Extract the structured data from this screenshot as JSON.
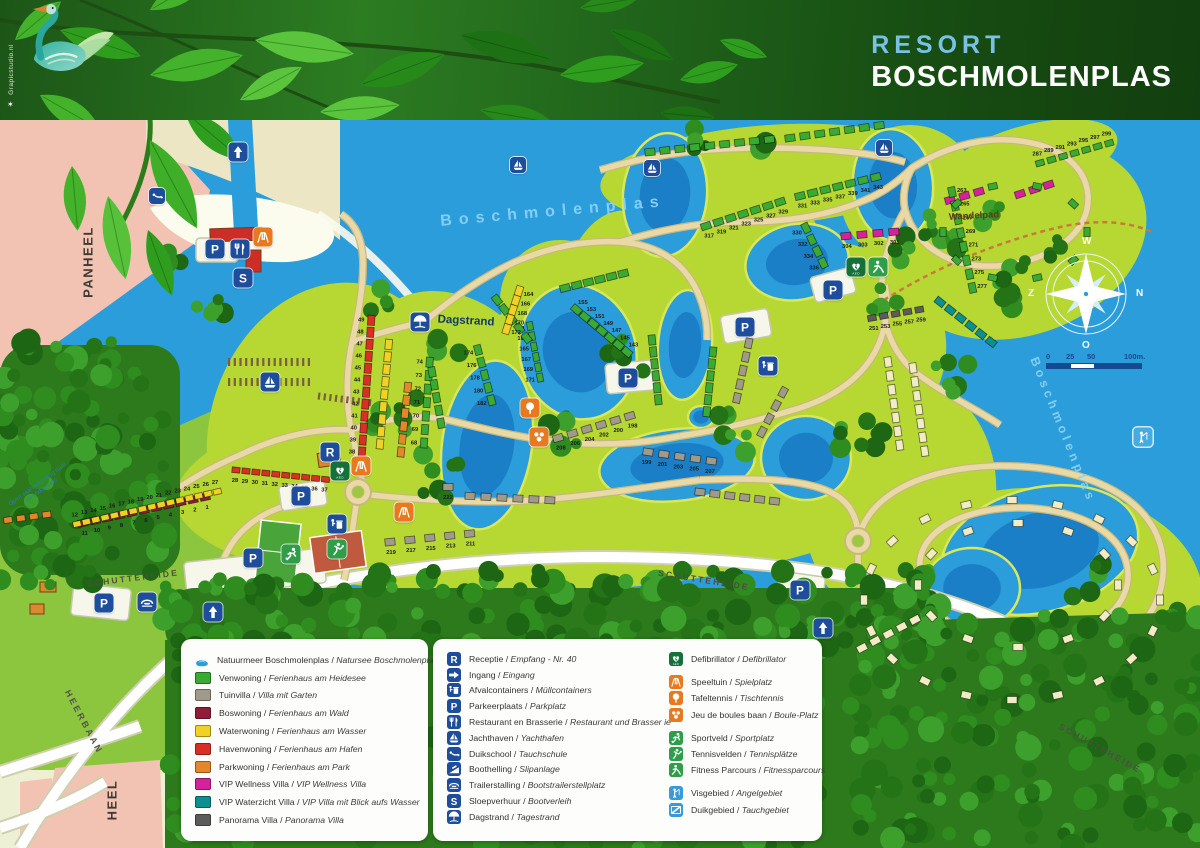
{
  "banner": {
    "resort_word": "RESORT",
    "name_word": "BOSCHMOLENPLAS",
    "watermark": "Grapicstudio.nl"
  },
  "palette": {
    "water": "#2b9ddb",
    "water_deep": "#1a7fc6",
    "land": "#edf0d2",
    "resort": "#b7d733",
    "grass": "#8cc63f",
    "pink_area": "#f2c3b2",
    "beach": "#fbfbee",
    "sand_strip": "#ece6c4",
    "road": "#e8d9a6",
    "road_edge": "#c9b87e",
    "forest_base": "#2c7a1b",
    "icon_blue": "#1d4d9b",
    "icon_green_dark": "#15713a",
    "icon_green": "#2e9e48",
    "icon_orange": "#e8791f",
    "icon_lightblue": "#3b9ad6",
    "venwoning": "#3aaa35",
    "tuinvilla": "#a09a8a",
    "boswoning": "#8f1d3a",
    "waterwoning": "#f2d126",
    "havenwoning": "#d93026",
    "parkwoning": "#e2882b",
    "vip_wellness": "#d6219c",
    "vip_waterzicht": "#0b8f8f",
    "panorama": "#5c5c5c",
    "cream": "#f2ecc4"
  },
  "compass": {
    "top": "W",
    "right": "N",
    "bottom": "O",
    "left": "Z"
  },
  "scalebar": {
    "labels": [
      "0",
      "25",
      "50",
      "100m."
    ]
  },
  "map": {
    "labels": [
      {
        "t": "PANHEEL",
        "x": 88,
        "y": 262,
        "r": -90,
        "cls": "place"
      },
      {
        "t": "HEEL",
        "x": 112,
        "y": 800,
        "r": -90,
        "cls": "place"
      },
      {
        "t": "HEERBAAN",
        "x": 84,
        "y": 722,
        "r": 62,
        "cls": "road-b"
      },
      {
        "t": "SCHUTTEHEIDE",
        "x": 133,
        "y": 578,
        "r": -7,
        "cls": "road"
      },
      {
        "t": "SCHUTTEHEIDE",
        "x": 704,
        "y": 580,
        "r": 9,
        "cls": "road"
      },
      {
        "t": "SCHUTTEHEIDE",
        "x": 1100,
        "y": 748,
        "r": 29,
        "cls": "road"
      },
      {
        "t": "Wandelpad",
        "x": 974,
        "y": 216,
        "r": -3,
        "cls": "pathl"
      },
      {
        "t": "Dagstrand",
        "x": 466,
        "y": 321,
        "r": 3,
        "cls": "dagstrand"
      },
      {
        "t": "Boschmolenplas",
        "x": 553,
        "y": 212,
        "r": -5,
        "cls": "water"
      },
      {
        "t": "Boschmolenplas",
        "x": 1063,
        "y": 430,
        "r": 68,
        "cls": "water sm"
      },
      {
        "t": "Open vaarverbinding naar de Middelplas",
        "x": 40,
        "y": 488,
        "r": -36,
        "cls": "tinyw"
      }
    ],
    "markers": [
      {
        "t": "ingang",
        "x": 238,
        "y": 152
      },
      {
        "t": "duikschool",
        "x": 157,
        "y": 196,
        "s": 16
      },
      {
        "t": "parkeer",
        "x": 215,
        "y": 249
      },
      {
        "t": "restaurant",
        "x": 240,
        "y": 249
      },
      {
        "t": "sloep",
        "x": 243,
        "y": 278
      },
      {
        "t": "speeltuin",
        "x": 263,
        "y": 237
      },
      {
        "t": "jachthaven",
        "x": 270,
        "y": 382
      },
      {
        "t": "dagstrand",
        "x": 420,
        "y": 322
      },
      {
        "t": "receptie",
        "x": 330,
        "y": 452
      },
      {
        "t": "defib",
        "x": 340,
        "y": 471
      },
      {
        "t": "speeltuin",
        "x": 361,
        "y": 466
      },
      {
        "t": "speeltuin",
        "x": 404,
        "y": 512
      },
      {
        "t": "parkeer",
        "x": 301,
        "y": 496
      },
      {
        "t": "afval",
        "x": 337,
        "y": 524
      },
      {
        "t": "tennis",
        "x": 337,
        "y": 549
      },
      {
        "t": "sportveld",
        "x": 291,
        "y": 554
      },
      {
        "t": "parkeer",
        "x": 253,
        "y": 558
      },
      {
        "t": "trailer",
        "x": 147,
        "y": 602
      },
      {
        "t": "parkeer",
        "x": 104,
        "y": 603
      },
      {
        "t": "ingang",
        "x": 213,
        "y": 612
      },
      {
        "t": "tafeltennis",
        "x": 530,
        "y": 408
      },
      {
        "t": "boules",
        "x": 539,
        "y": 437
      },
      {
        "t": "parkeer",
        "x": 628,
        "y": 378
      },
      {
        "t": "parkeer",
        "x": 745,
        "y": 327
      },
      {
        "t": "afval",
        "x": 768,
        "y": 366
      },
      {
        "t": "parkeer",
        "x": 833,
        "y": 290
      },
      {
        "t": "defib",
        "x": 856,
        "y": 267
      },
      {
        "t": "fitness",
        "x": 878,
        "y": 267
      },
      {
        "t": "jachthaven",
        "x": 518,
        "y": 165,
        "s": 16
      },
      {
        "t": "jachthaven",
        "x": 652,
        "y": 168,
        "s": 16
      },
      {
        "t": "jachthaven",
        "x": 884,
        "y": 148,
        "s": 16
      },
      {
        "t": "vis",
        "x": 1143,
        "y": 437,
        "light": true
      },
      {
        "t": "parkeer",
        "x": 800,
        "y": 590
      },
      {
        "t": "ingang",
        "x": 823,
        "y": 628
      }
    ],
    "house_clusters": [
      {
        "x": 205,
        "y": 497,
        "a": 168,
        "n": 11,
        "c": "boswoning",
        "g": 12.5,
        "num": 1,
        "side": -1
      },
      {
        "x": 77,
        "y": 524,
        "a": -13,
        "n": 16,
        "c": "waterwoning",
        "g": 9.6,
        "s": 0.8,
        "num": 12,
        "side": -1
      },
      {
        "x": 236,
        "y": 470,
        "a": 6,
        "n": 10,
        "c": "havenwoning",
        "g": 10,
        "s": 0.8,
        "num": 28,
        "side": 1
      },
      {
        "x": 362,
        "y": 452,
        "a": -86,
        "n": 12,
        "c": "havenwoning",
        "g": 12,
        "num": 38,
        "side": -1
      },
      {
        "x": 380,
        "y": 444,
        "a": -85,
        "n": 9,
        "c": "waterwoning",
        "g": 12.5
      },
      {
        "x": 424,
        "y": 443,
        "a": -86,
        "n": 7,
        "c": "venwoning",
        "g": 13.5,
        "num": 68,
        "side": -1
      },
      {
        "x": 401,
        "y": 452,
        "a": -84,
        "n": 6,
        "c": "parkwoning",
        "g": 13
      },
      {
        "x": 8,
        "y": 520,
        "a": -8,
        "n": 4,
        "c": "parkwoning",
        "s": 0.85
      },
      {
        "x": 530,
        "y": 326,
        "a": 79,
        "n": 6,
        "c": "venwoning",
        "g": 10.5,
        "s": 0.85,
        "num": 161,
        "step": 2,
        "side": 1
      },
      {
        "x": 497,
        "y": 300,
        "a": 52,
        "n": 5,
        "c": "venwoning",
        "g": 12
      },
      {
        "x": 627,
        "y": 352,
        "a": -140,
        "n": 7,
        "c": "venwoning",
        "g": 11,
        "num": 143,
        "step": 2,
        "side": 1
      },
      {
        "x": 565,
        "y": 288,
        "a": -14,
        "n": 6,
        "c": "venwoning",
        "g": 12
      },
      {
        "x": 519,
        "y": 291,
        "a": 108,
        "n": 5,
        "c": "waterwoning",
        "g": 10,
        "num": 164,
        "step": 2,
        "side": -1
      },
      {
        "x": 652,
        "y": 340,
        "a": 84,
        "n": 6,
        "c": "venwoning",
        "g": 12
      },
      {
        "x": 713,
        "y": 352,
        "a": 96,
        "n": 6,
        "c": "venwoning",
        "g": 12
      },
      {
        "x": 478,
        "y": 350,
        "a": 75,
        "n": 5,
        "c": "venwoning",
        "g": 13,
        "num": 174,
        "step": 2,
        "side": 1
      },
      {
        "x": 432,
        "y": 372,
        "a": 80,
        "n": 5,
        "c": "venwoning",
        "g": 13
      },
      {
        "x": 390,
        "y": 542,
        "a": -6,
        "n": 5,
        "c": "tuinvilla",
        "g": 20,
        "num": 219,
        "step": -2,
        "side": 1
      },
      {
        "x": 448,
        "y": 487,
        "a": 0,
        "n": 1,
        "c": "tuinvilla",
        "num": 222,
        "side": 1
      },
      {
        "x": 470,
        "y": 496,
        "a": 3,
        "n": 6,
        "c": "tuinvilla",
        "g": 16
      },
      {
        "x": 558,
        "y": 438,
        "a": -17,
        "n": 6,
        "c": "tuinvilla",
        "g": 15,
        "num": 208,
        "step": -2,
        "side": 1
      },
      {
        "x": 648,
        "y": 452,
        "a": 8,
        "n": 5,
        "c": "tuinvilla",
        "g": 16,
        "num": 199,
        "step": 2,
        "side": 1
      },
      {
        "x": 700,
        "y": 492,
        "a": 7,
        "n": 6,
        "c": "tuinvilla",
        "g": 15
      },
      {
        "x": 762,
        "y": 432,
        "a": -62,
        "n": 4,
        "c": "tuinvilla",
        "g": 15
      },
      {
        "x": 737,
        "y": 398,
        "a": -78,
        "n": 5,
        "c": "tuinvilla",
        "g": 14
      },
      {
        "x": 872,
        "y": 318,
        "a": -10,
        "n": 5,
        "c": "panorama",
        "g": 12,
        "s": 0.85,
        "num": 251,
        "step": 2,
        "side": 1
      },
      {
        "x": 940,
        "y": 302,
        "a": 38,
        "n": 6,
        "c": "vip_waterzicht",
        "g": 13
      },
      {
        "x": 806,
        "y": 228,
        "a": 64,
        "n": 4,
        "c": "venwoning",
        "g": 13,
        "num": 330,
        "step": 2,
        "side": 1
      },
      {
        "x": 846,
        "y": 236,
        "a": -5,
        "n": 4,
        "c": "vip_wellness",
        "g": 16,
        "num": 304,
        "step": -1,
        "side": 1
      },
      {
        "x": 1020,
        "y": 194,
        "a": -18,
        "n": 3,
        "c": "vip_wellness",
        "g": 15
      },
      {
        "x": 950,
        "y": 200,
        "a": -16,
        "n": 3,
        "c": "vip_wellness",
        "g": 15
      },
      {
        "x": 706,
        "y": 226,
        "a": -18,
        "n": 7,
        "c": "venwoning",
        "g": 13,
        "num": 317,
        "step": 2,
        "side": 1
      },
      {
        "x": 800,
        "y": 196,
        "a": -14,
        "n": 7,
        "c": "venwoning",
        "g": 13,
        "num": 331,
        "step": 2,
        "side": 1
      },
      {
        "x": 650,
        "y": 152,
        "a": -6,
        "n": 9,
        "c": "venwoning",
        "g": 15
      },
      {
        "x": 790,
        "y": 138,
        "a": -8,
        "n": 7,
        "c": "venwoning",
        "g": 15
      },
      {
        "x": 1040,
        "y": 163,
        "a": -16,
        "n": 7,
        "c": "venwoning",
        "g": 12,
        "s": 0.85,
        "num": 287,
        "step": 2,
        "side": -1
      },
      {
        "x": 952,
        "y": 192,
        "a": 78,
        "n": 8,
        "c": "venwoning",
        "g": 14,
        "num": 263,
        "step": 2,
        "side": -1
      },
      {
        "x": 888,
        "y": 362,
        "a": 82,
        "n": 7,
        "c": "cream",
        "g": 14
      },
      {
        "x": 913,
        "y": 368,
        "a": 82,
        "n": 7,
        "c": "cream",
        "g": 14
      },
      {
        "ring": true,
        "cx": 1015,
        "cy": 232,
        "rx": 72,
        "ry": 48,
        "n": 10,
        "c": "venwoning",
        "s": 0.9
      },
      {
        "ring": true,
        "cx": 1012,
        "cy": 600,
        "rx": 148,
        "ry": 100,
        "n": 20,
        "c": "cream"
      },
      {
        "ring": true,
        "cx": 1018,
        "cy": 585,
        "rx": 100,
        "ry": 62,
        "n": 12,
        "c": "cream"
      },
      {
        "x": 862,
        "y": 648,
        "a": -28,
        "n": 5,
        "c": "cream",
        "g": 15
      }
    ]
  },
  "legend": {
    "housing": [
      {
        "sw": "lake",
        "nl": "Natuurmeer Boschmolenplas",
        "de": "Natursee Boschmolenplas"
      },
      {
        "sw": "venwoning",
        "nl": "Venwoning",
        "de": "Ferienhaus am Heidesee"
      },
      {
        "sw": "tuinvilla",
        "nl": "Tuinvilla",
        "de": "Villa mit Garten"
      },
      {
        "sw": "boswoning",
        "nl": "Boswoning",
        "de": "Ferienhaus am Wald"
      },
      {
        "sw": "waterwoning",
        "nl": "Waterwoning",
        "de": "Ferienhaus am Wasser"
      },
      {
        "sw": "havenwoning",
        "nl": "Havenwoning",
        "de": "Ferienhaus am Hafen"
      },
      {
        "sw": "parkwoning",
        "nl": "Parkwoning",
        "de": "Ferienhaus am Park"
      },
      {
        "sw": "vip_wellness",
        "nl": "VIP Wellness Villa",
        "de": "VIP Wellness Villa"
      },
      {
        "sw": "vip_waterzicht",
        "nl": "VIP Waterzicht Villa",
        "de": "VIP Villa mit Blick aufs Wasser"
      },
      {
        "sw": "panorama",
        "nl": "Panorama Villa",
        "de": "Panorama Villa"
      }
    ],
    "facilities": [
      {
        "icon": "receptie",
        "nl": "Receptie",
        "de": "Empfang - Nr. 40"
      },
      {
        "icon": "ingang-r",
        "nl": "Ingang",
        "de": "Eingang"
      },
      {
        "icon": "afval",
        "nl": "Afvalcontainers",
        "de": "Müllcontainers"
      },
      {
        "icon": "parkeer",
        "nl": "Parkeerplaats",
        "de": "Parkplatz"
      },
      {
        "icon": "restaurant",
        "nl": "Restaurant en Brasserie",
        "de": "Restaurant und Brasser ie"
      },
      {
        "icon": "jachthaven",
        "nl": "Jachthaven",
        "de": "Yachthafen"
      },
      {
        "icon": "duikschool",
        "nl": "Duikschool",
        "de": "Tauchschule"
      },
      {
        "icon": "boothelling",
        "nl": "Boothelling",
        "de": "Slipanlage"
      },
      {
        "icon": "trailer",
        "nl": "Trailerstalling",
        "de": "Bootstrailerstellplatz"
      },
      {
        "icon": "sloep",
        "nl": "Sloepverhuur",
        "de": "Bootverleih"
      },
      {
        "icon": "dagstrand",
        "nl": "Dagstrand",
        "de": "Tagestrand"
      }
    ],
    "activities": [
      {
        "icon": "defib",
        "nl": "Defibrillator",
        "de": "Defibrillator",
        "group": 1
      },
      {
        "icon": "speeltuin",
        "nl": "Speeltuin",
        "de": "Spielplatz",
        "group": 2
      },
      {
        "icon": "tafeltennis",
        "nl": "Tafeltennis",
        "de": "Tischtennis",
        "group": 2
      },
      {
        "icon": "boules",
        "nl": "Jeu de boules baan",
        "de": "Boule-Platz",
        "group": 2
      },
      {
        "icon": "sportveld",
        "nl": "Sportveld",
        "de": "Sportplatz",
        "group": 3
      },
      {
        "icon": "tennis",
        "nl": "Tennisvelden",
        "de": "Tennisplätze",
        "group": 3
      },
      {
        "icon": "fitness",
        "nl": "Fitness Parcours",
        "de": "Fitnessparcours",
        "group": 3
      },
      {
        "icon": "vis",
        "nl": "Visgebied",
        "de": "Angelgebiet",
        "group": 4
      },
      {
        "icon": "duik",
        "nl": "Duikgebied",
        "de": "Tauchgebiet",
        "group": 4
      }
    ]
  }
}
